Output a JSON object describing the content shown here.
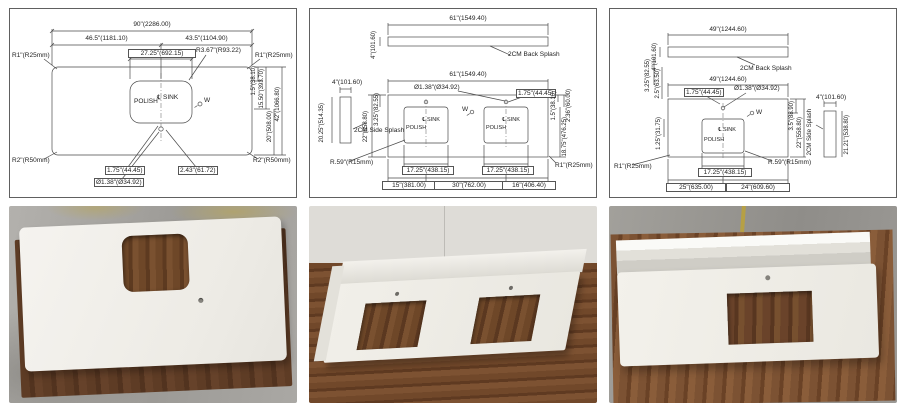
{
  "colors": {
    "drawing_line": "#4a4a4a",
    "panel_border": "#606060",
    "background": "#ffffff",
    "slab_white": "#f0eee9",
    "wood_brown": "#6e4728",
    "concrete_gray": "#a3a19c",
    "wall_gray": "#dedcd7",
    "paint_stain_yellow": "#b6a045"
  },
  "drawings": [
    {
      "overall_width": "90\"(2286.00)",
      "dim_left_to_sink_center": "46.5\"(1181.10)",
      "dim_sink_center_to_right": "43.5\"(1104.90)",
      "sink_width": "27.25\"(692.15)",
      "sink_corner_radius": "R3.67\"(R93.22)",
      "radius_top_left": "R1\"(R25mm)",
      "radius_top_right": "R1\"(R25mm)",
      "radius_bottom_left": "R2\"(R50mm)",
      "radius_bottom_right": "R2\"(R50mm)",
      "dim_faucet_offset": "1.75\"(44.45)",
      "dim_faucet_to_sink": "2.43\"(61.72)",
      "faucet_hole": "Ø1.38\"(Ø34.92)",
      "right_d1": "1.5\"(38.10)",
      "right_d2": "15.50\"(393.70)",
      "right_d3": "20\"(508.00)",
      "right_d4": "42\"(1066.80)",
      "labels": {
        "polish": "POLISH",
        "sink": "℄ SINK",
        "w": "W"
      }
    },
    {
      "backsplash": {
        "width": "61\"(1549.40)",
        "height": "4\"(101.60)",
        "callout": "2CM Back Splash"
      },
      "sidesplash": {
        "width": "4\"(101.60)",
        "height": "20.25\"(514.35)",
        "callout": "2CM Side Splash"
      },
      "overall_width": "61\"(1549.40)",
      "depth": "22\"(558.80)",
      "dim_back_to_cutout": "3.25\"(82.55)",
      "faucet_hole": "Ø1.38\"(Ø34.92)",
      "dim_faucet_offset": "1.75\"(44.45)",
      "sink_width_left": "17.25\"(438.15)",
      "sink_width_right": "17.25\"(438.15)",
      "bottom_left": "15\"(381.00)",
      "bottom_center": "30\"(762.00)",
      "bottom_right": "16\"(406.40)",
      "right_d1": "1.5\"(38.10)",
      "right_d2": "2.36\"(60.00)",
      "right_d3": "18.75\"(476.25)",
      "radius_sink": "R.59\"(R15mm)",
      "radius_corner": "R1\"(R25mm)",
      "labels": {
        "polish": "POLISH",
        "sink": "℄ SINK",
        "w": "W"
      }
    },
    {
      "backsplash": {
        "width": "49\"(1244.60)",
        "height": "4\"(101.60)",
        "callout": "2CM Back Splash"
      },
      "sidesplash": {
        "width": "4\"(101.60)",
        "height": "21.21\"(538.80)",
        "callout": "2CM Side Splash"
      },
      "overall_width": "49\"(1244.60)",
      "left_d1": "3.25\"(82.55)",
      "left_d2": "2.5\"(63.50)",
      "left_d3": "1.25\"(31.75)",
      "right_d1": "3.5\"(88.90)",
      "right_d2": "22\"(558.80)",
      "dim_faucet_offset": "1.75\"(44.45)",
      "faucet_hole": "Ø1.38\"(Ø34.92)",
      "sink_width": "17.25\"(438.15)",
      "bottom_left": "25\"(635.00)",
      "bottom_right": "24\"(609.60)",
      "radius_corner": "R1\"(R25mm)",
      "radius_sink": "R.59\"(R15mm)",
      "labels": {
        "polish": "POLISH",
        "sink": "℄ SINK",
        "w": "W"
      }
    }
  ]
}
